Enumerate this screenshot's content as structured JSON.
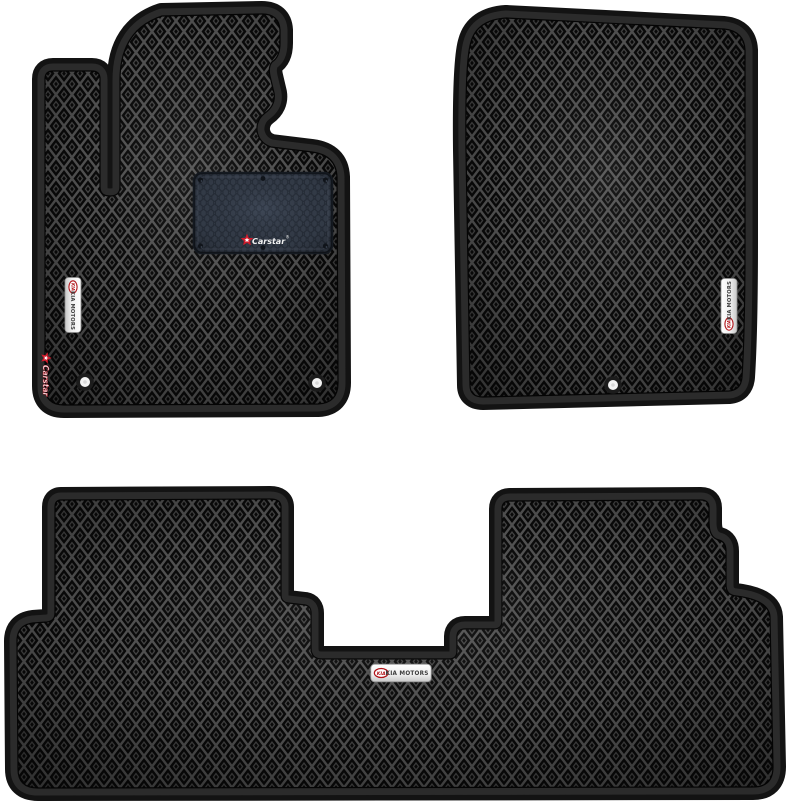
{
  "product": {
    "name": "EVA car floor mats set (3 pieces)",
    "mats": [
      {
        "id": "driver-front-mat",
        "position": "top-left",
        "details": "heel pad, vertical KIA MOTORS badge, vertical Carstar embroidery, 2 fastener grommets"
      },
      {
        "id": "passenger-front-mat",
        "position": "top-right",
        "details": "vertical KIA MOTORS badge, 1 fastener grommet"
      },
      {
        "id": "rear-row-mat",
        "position": "bottom",
        "details": "horizontal KIA MOTORS badge"
      }
    ]
  },
  "branding": {
    "carstar_label": "Carstar",
    "registered_mark": "®",
    "kia_oval_text": "KIA",
    "kia_motors_text": "KIA MOTORS"
  },
  "colors": {
    "background": "#ffffff",
    "mat_surface": "#0a0a0a",
    "pattern_line": "#565656",
    "border_band": "#2b2b2b",
    "border_rim": "#131313",
    "heel_pad": "#353d4a",
    "heel_pad_line": "#262d38",
    "badge_face": "#f6f6f6",
    "kia_red": "#b11218",
    "carstar_red": "#cf1b2b",
    "badge_text": "#3d3d3d",
    "grommet_white": "#f3f3f3"
  }
}
